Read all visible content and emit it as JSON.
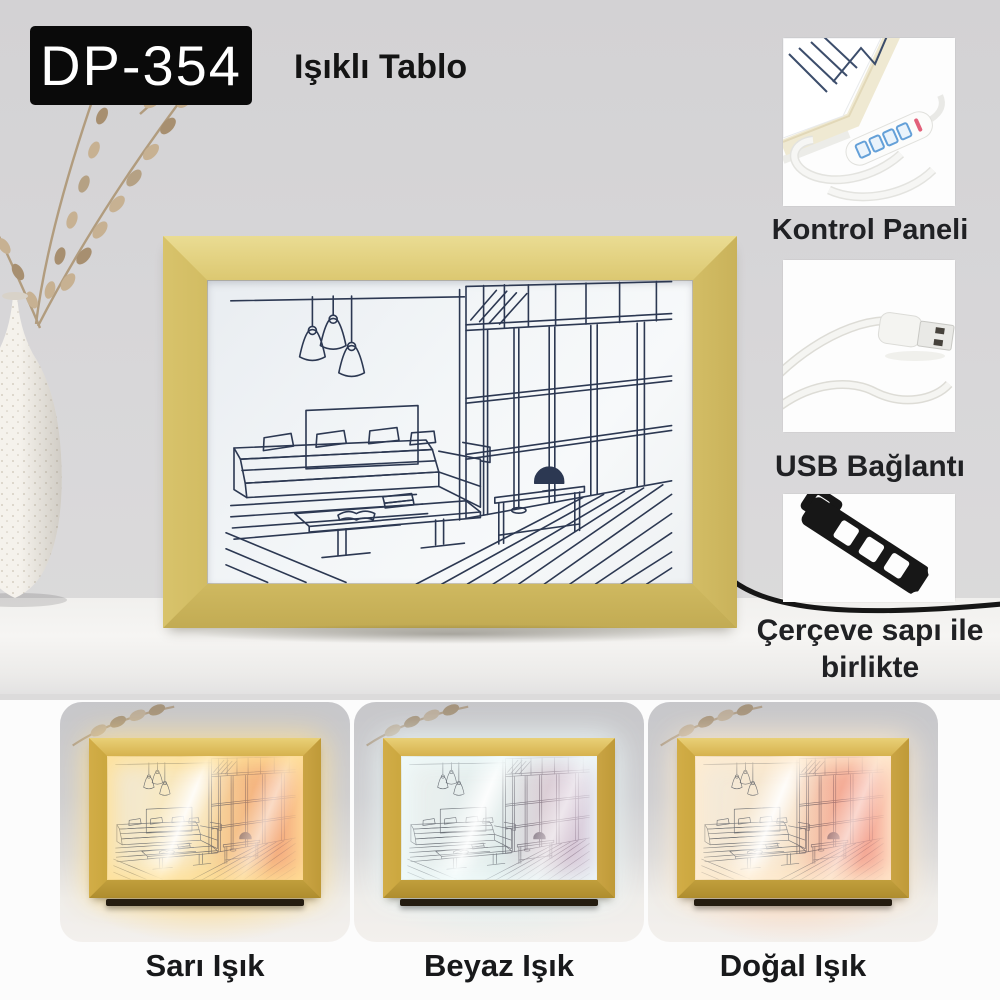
{
  "header": {
    "model_badge": "DP-354",
    "title": "Işıklı Tablo"
  },
  "features": [
    {
      "label": "Kontrol Paneli",
      "icon": "control-panel-photo"
    },
    {
      "label": "USB Bağlantı",
      "icon": "usb-plug-photo"
    },
    {
      "label": "Çerçeve sapı ile birlikte",
      "icon": "frame-stand-photo"
    }
  ],
  "variants": [
    {
      "label": "Sarı Işık",
      "light": "warm-yellow"
    },
    {
      "label": "Beyaz Işık",
      "light": "cool-white"
    },
    {
      "label": "Doğal Işık",
      "light": "natural-warm"
    }
  ],
  "colors": {
    "badge_bg": "#0a0a0a",
    "badge_text": "#ffffff",
    "frame_wood": "#d7c268",
    "frame_gold": "#cda843",
    "panel_ink": "#2c3852",
    "background_wall": "#d8d7d9"
  }
}
